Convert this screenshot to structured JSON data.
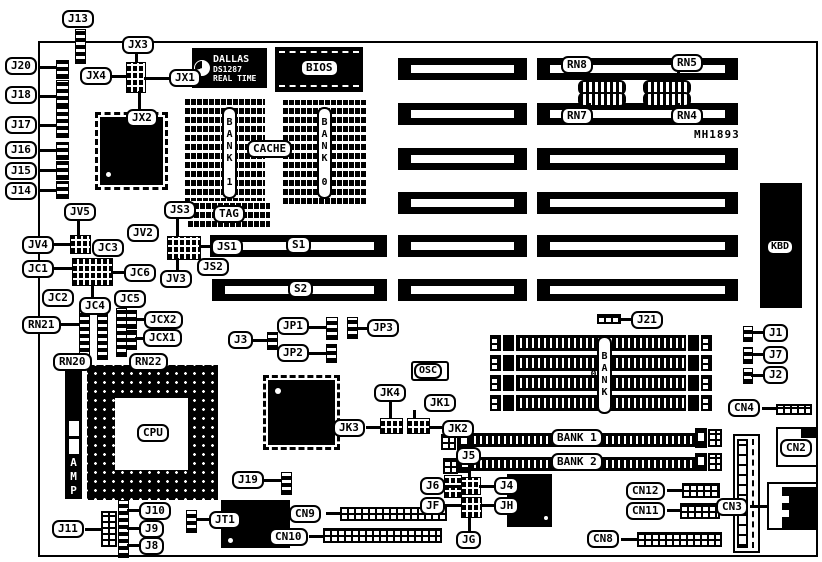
{
  "colors": {
    "ink": "#000000",
    "paper": "#ffffff"
  },
  "board": {
    "part_number": "MH1893"
  },
  "chips": {
    "rtc_brand": "DALLAS",
    "rtc_part": "DS1287",
    "rtc_line": "REAL TIME",
    "bios": "BIOS",
    "cache": "CACHE",
    "tag": "TAG",
    "cpu": "CPU",
    "osc": "OSC",
    "kbd": "KBD",
    "amp": "AMP"
  },
  "memory": {
    "cache_bank1": "BANK 1",
    "cache_bank0": "BANK 0",
    "simm_bank0": "BANK 0",
    "simm_bank1": "BANK 1",
    "simm_bank2": "BANK 2"
  },
  "slots": {
    "s1": "S1",
    "s2": "S2"
  },
  "callouts": {
    "j13": "J13",
    "j20": "J20",
    "j18": "J18",
    "j17": "J17",
    "j16": "J16",
    "j15": "J15",
    "j14": "J14",
    "jx3": "JX3",
    "jx4": "JX4",
    "jx1": "JX1",
    "jx2": "JX2",
    "jv5": "JV5",
    "jv4": "JV4",
    "jv2": "JV2",
    "jv3": "JV3",
    "jc1": "JC1",
    "jc2": "JC2",
    "jc3": "JC3",
    "jc4": "JC4",
    "jc5": "JC5",
    "jc6": "JC6",
    "jcx2": "JCX2",
    "jcx1": "JCX1",
    "js3": "JS3",
    "js1": "JS1",
    "js2": "JS2",
    "rn21": "RN21",
    "rn20": "RN20",
    "rn22": "RN22",
    "rn8": "RN8",
    "rn5": "RN5",
    "rn7": "RN7",
    "rn4": "RN4",
    "j3": "J3",
    "jp1": "JP1",
    "jp2": "JP2",
    "jp3": "JP3",
    "jk4": "JK4",
    "jk1": "JK1",
    "jk3": "JK3",
    "jk2": "JK2",
    "j21": "J21",
    "j1": "J1",
    "j7": "J7",
    "j2": "J2",
    "j5": "J5",
    "j6": "J6",
    "j4": "J4",
    "jf": "JF",
    "jh": "JH",
    "jg": "JG",
    "j19": "J19",
    "j10": "J10",
    "j9": "J9",
    "j8": "J8",
    "j11": "J11",
    "jt1": "JT1",
    "cn4": "CN4",
    "cn2": "CN2",
    "cn3": "CN3",
    "cn12": "CN12",
    "cn11": "CN11",
    "cn9": "CN9",
    "cn10": "CN10",
    "cn8": "CN8"
  }
}
